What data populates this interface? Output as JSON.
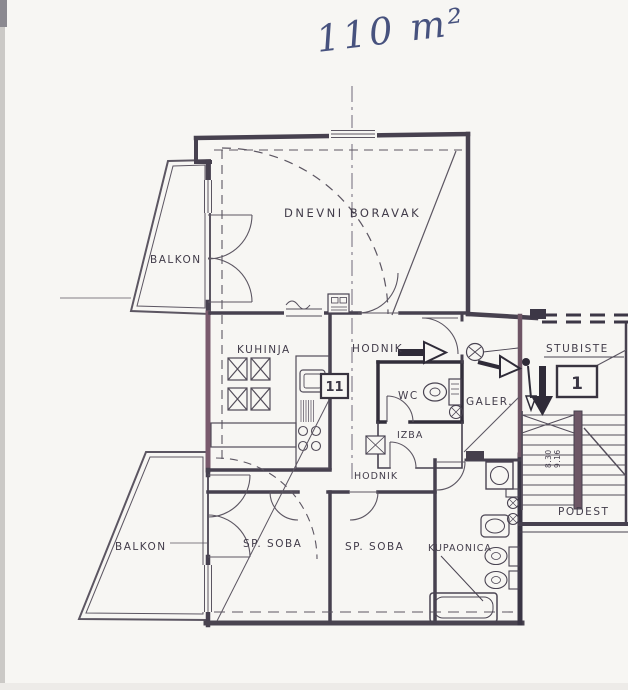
{
  "note": {
    "area": "110 m²"
  },
  "rooms": {
    "living": {
      "label": "DNEVNI BORAVAK"
    },
    "kitchen": {
      "label": "KUHINJA"
    },
    "hall_upper": {
      "label": "HODNIK"
    },
    "hall_lower": {
      "label": "HODNIK"
    },
    "wc": {
      "label": "WC"
    },
    "pantry": {
      "label": "IZBA"
    },
    "gallery": {
      "label": "GALER."
    },
    "staircase": {
      "label": "STUBISTE"
    },
    "landing": {
      "label": "PODEST"
    },
    "bedroom1": {
      "label": "SP. SOBA"
    },
    "bedroom2": {
      "label": "SP. SOBA"
    },
    "bathroom": {
      "label": "KUPAONICA"
    },
    "balcony_upper": {
      "label": "BALKON"
    },
    "balcony_lower": {
      "label": "BALKON"
    }
  },
  "markers": {
    "unit_box": "11",
    "entrance_box": "1",
    "stair_dim_a": "8.30",
    "stair_dim_b": "9.16"
  },
  "colors": {
    "paper": "#f7f6f3",
    "ink": "#3a3644",
    "wall": "#47414f",
    "wall_dark": "#322e3a",
    "wall_accent": "#7a5a6d",
    "thin_line": "#5c5662",
    "handwriting_ink": "#47527e"
  }
}
